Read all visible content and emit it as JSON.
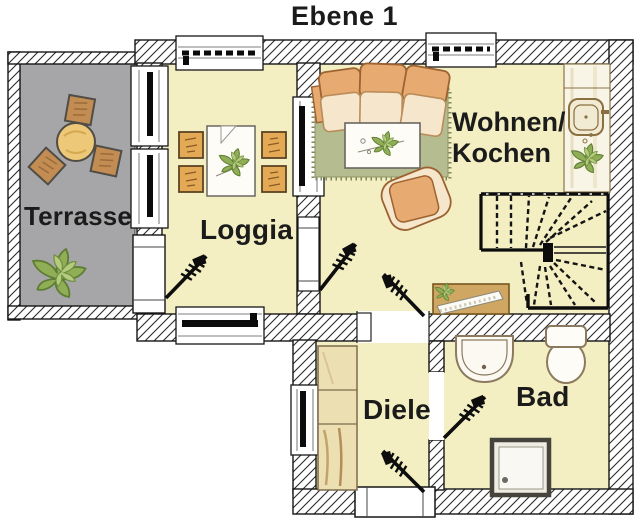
{
  "title": "Ebene 1",
  "rooms": {
    "terrasse": {
      "label": "Terrasse"
    },
    "loggia": {
      "label": "Loggia"
    },
    "wohnen_kochen": {
      "label_line1": "Wohnen/",
      "label_line2": "Kochen"
    },
    "diele": {
      "label": "Diele"
    },
    "bad": {
      "label": "Bad"
    }
  },
  "colors": {
    "room_fill": "#f3efc3",
    "terrace_fill": "#a6a6a8",
    "rug_fill": "#b5bc90",
    "wall_line": "#1c1c1c",
    "sofa_orange": "#e7aa70",
    "cushion_cream": "#f6e6cc",
    "furniture_wood": "#cfa763",
    "plant_green": "#8fae55",
    "label_text": "#1b1b1b"
  }
}
